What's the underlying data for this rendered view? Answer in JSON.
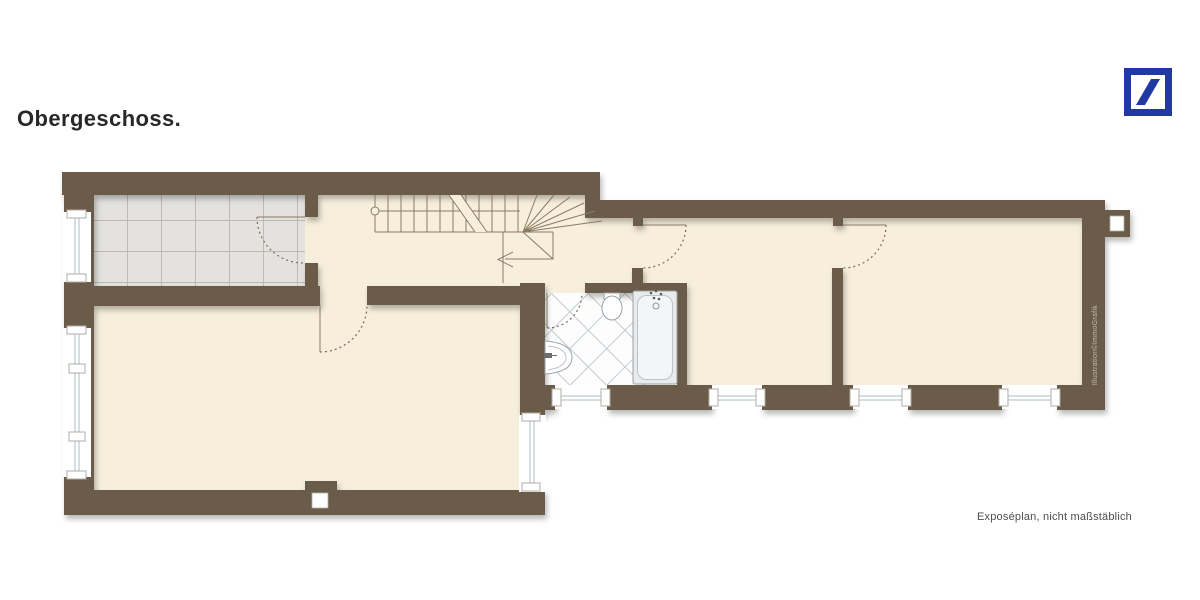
{
  "title": "Obergeschoss.",
  "footer_note": "Exposéplan, nicht maßstäblich",
  "watermark": "Illustration©ImmoGrafik",
  "logo": {
    "icon": "deutsche-bank-slash-icon"
  },
  "colors": {
    "wall": "#6b5b4a",
    "floor": "#f7efdc",
    "tile_floor": "#e3e2df",
    "tile_grid": "#bdbab3",
    "bath_line": "#c3ccd2",
    "glass": "#a9bec7",
    "plan_line": "#8b7a64",
    "dash": "#7d6c56",
    "fixture": "#98a2a6",
    "logo_blue": "#2139a3",
    "text_dark": "#282828",
    "text_gray": "#4d4d4d",
    "watermark_color": "#c9bdac"
  }
}
